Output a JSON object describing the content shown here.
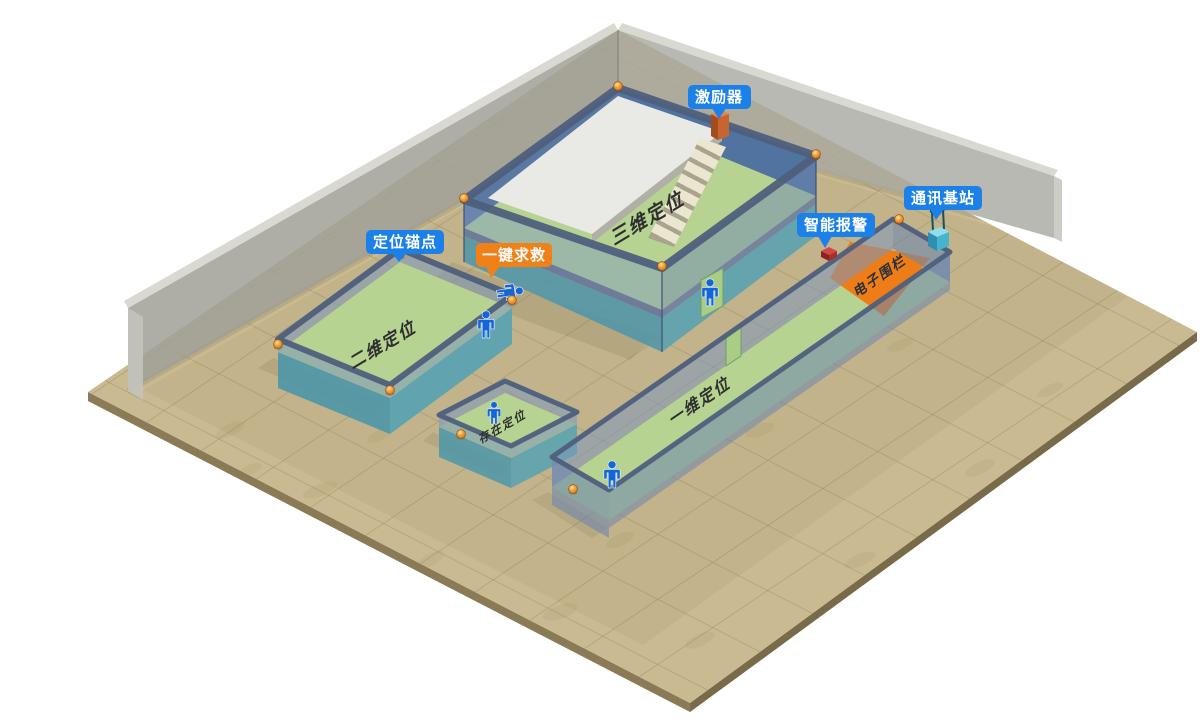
{
  "scene": {
    "colors": {
      "background": "#ffffff",
      "floor": "#c9ba92",
      "floor_edge": "#8a7a56",
      "back_wall": "#a0a098",
      "back_wall_top": "#d7d7cf",
      "zone_floor": "#b7d392",
      "wall_slate": "#7d97bd",
      "wall_teal": "#4e96a8",
      "rim": "#4e5f7c",
      "fence": "#ee7d18",
      "callout_blue": "#1b80e8",
      "callout_orange": "#f08018",
      "person_blue": "#1465d8",
      "anchor_orange": "#e07818",
      "white_platform": "#e9e9e6"
    }
  },
  "callouts": {
    "exciter": "激励器",
    "comm_base": "通讯基站",
    "smart_alarm": "智能报警",
    "anchor": "定位锚点",
    "sos": "一键求救"
  },
  "zones": {
    "three_d": "三维定位",
    "two_d": "二维定位",
    "presence": "存在定位",
    "one_d": "一维定位",
    "fence": "电子围栏"
  }
}
